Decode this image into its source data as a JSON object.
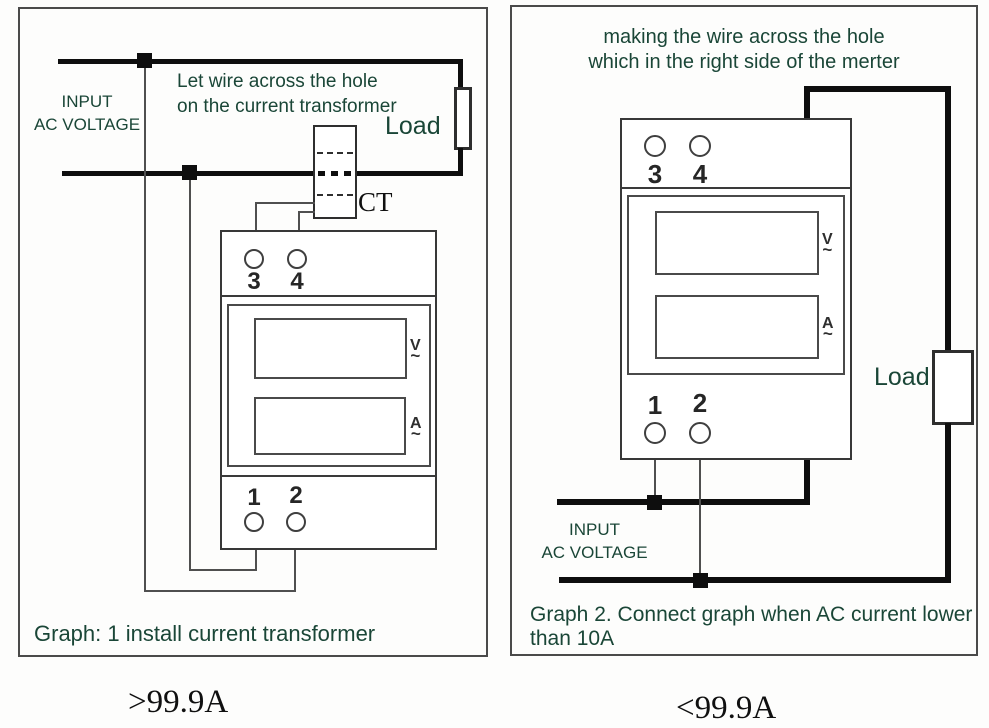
{
  "left_panel": {
    "input_line1": "INPUT",
    "input_line2": "AC VOLTAGE",
    "note_line1": "Let wire across the hole",
    "note_line2": "on the current transformer",
    "load_label": "Load",
    "ct_label": "CT",
    "meter": {
      "t3": "3",
      "t4": "4",
      "t1": "1",
      "t2": "2",
      "v": "V",
      "a": "A",
      "tilde": "~"
    },
    "caption": "Graph: 1 install current transformer",
    "rating": ">99.9A"
  },
  "right_panel": {
    "note_line1": "making the wire across the hole",
    "note_line2": "which in the right side of the merter",
    "meter": {
      "t3": "3",
      "t4": "4",
      "t1": "1",
      "t2": "2",
      "v": "V",
      "a": "A",
      "tilde": "~"
    },
    "load_label": "Load",
    "input_line1": "INPUT",
    "input_line2": "AC VOLTAGE",
    "caption_line1": "Graph 2. Connect graph when AC current lower",
    "caption_line2": "than 10A",
    "rating": "<99.9A"
  },
  "colors": {
    "text_green": "#1a4637",
    "wire_black": "#0e0e0e",
    "outline_gray": "#3c3c3c"
  }
}
